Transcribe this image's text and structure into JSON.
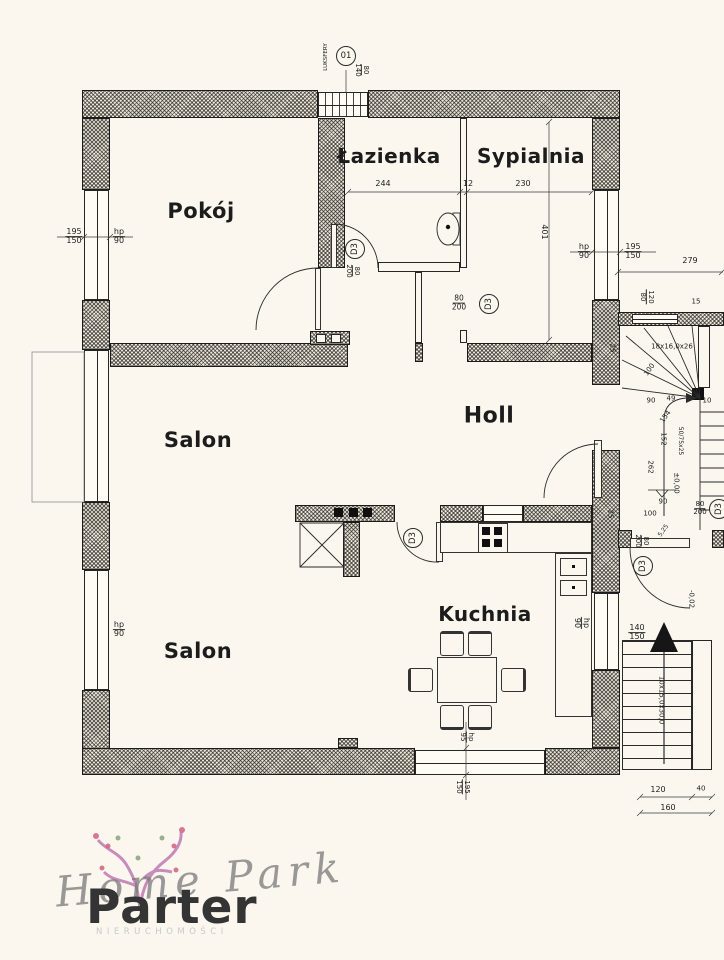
{
  "page_title": "Parter",
  "colors": {
    "background": "#fbf7ee",
    "line": "#262626",
    "wall_fill": "#ece5d6",
    "logo_pink": "#c07ab2",
    "logo_green": "#8aab7e",
    "logo_gray": "#9b9b9b",
    "logo_title_color": "#343434"
  },
  "logo": {
    "script": "Home Park",
    "subtitle": "NIERUCHOMOŚCI",
    "floor_title": "Parter"
  },
  "rooms": [
    {
      "t": "Pokój",
      "x": 201,
      "y": 211,
      "fs": 21
    },
    {
      "t": "Łazienka",
      "x": 389,
      "y": 156,
      "fs": 20
    },
    {
      "t": "Sypialnia",
      "x": 531,
      "y": 156,
      "fs": 20
    },
    {
      "t": "Salon",
      "x": 198,
      "y": 440,
      "fs": 21
    },
    {
      "t": "Holl",
      "x": 489,
      "y": 416,
      "fs": 22
    },
    {
      "t": "Salon",
      "x": 198,
      "y": 651,
      "fs": 21
    },
    {
      "t": "Kuchnia",
      "x": 485,
      "y": 614,
      "fs": 20
    }
  ],
  "door_tags": [
    {
      "t": "01",
      "x": 346,
      "y": 56,
      "n": "glass-block-window-tag"
    },
    {
      "t": "D3",
      "x": 355,
      "y": 249,
      "r": -90,
      "n": "door-tag-bathroom"
    },
    {
      "t": "D3",
      "x": 489,
      "y": 304,
      "r": -90,
      "n": "door-tag-bedroom"
    },
    {
      "t": "D3",
      "x": 413,
      "y": 538,
      "r": -90,
      "n": "door-tag-kitchen"
    },
    {
      "t": "D3",
      "x": 643,
      "y": 566,
      "r": -90,
      "n": "door-tag-back-entrance"
    },
    {
      "t": "D3",
      "x": 719,
      "y": 509,
      "r": -90,
      "n": "door-tag-stairwell"
    }
  ],
  "dimensions": [
    {
      "t": "LUKSFERY",
      "x": 327,
      "y": 57,
      "r": -90,
      "fs": 5.5
    },
    {
      "t": "80|140",
      "x": 361,
      "y": 70,
      "r": 90,
      "fs": 7
    },
    {
      "t": "244",
      "x": 383,
      "y": 184
    },
    {
      "t": "12",
      "x": 468,
      "y": 184
    },
    {
      "t": "230",
      "x": 523,
      "y": 184
    },
    {
      "t": "401",
      "x": 544,
      "y": 232,
      "r": 90
    },
    {
      "t": "195|150",
      "x": 74,
      "y": 237
    },
    {
      "t": "hp|90",
      "x": 119,
      "y": 237
    },
    {
      "t": "hp|90",
      "x": 584,
      "y": 252
    },
    {
      "t": "195|150",
      "x": 633,
      "y": 252
    },
    {
      "t": "279",
      "x": 690,
      "y": 261
    },
    {
      "t": "120|80",
      "x": 646,
      "y": 297,
      "r": 90,
      "fs": 7
    },
    {
      "t": "15",
      "x": 696,
      "y": 302,
      "fs": 7
    },
    {
      "t": "80|200",
      "x": 352,
      "y": 271,
      "r": 90,
      "fs": 7
    },
    {
      "t": "80|200",
      "x": 459,
      "y": 303,
      "fs": 7.5
    },
    {
      "t": "18x16,0x26",
      "x": 672,
      "y": 347,
      "fs": 7
    },
    {
      "t": "25",
      "x": 612,
      "y": 348,
      "r": 90,
      "fs": 7
    },
    {
      "t": "100",
      "x": 650,
      "y": 370,
      "r": -55,
      "fs": 7
    },
    {
      "t": "90",
      "x": 651,
      "y": 401,
      "fs": 7
    },
    {
      "t": "49",
      "x": 671,
      "y": 399,
      "fs": 7
    },
    {
      "t": "10",
      "x": 707,
      "y": 401,
      "fs": 7
    },
    {
      "t": "154",
      "x": 666,
      "y": 417,
      "r": -55,
      "fs": 7
    },
    {
      "t": "152",
      "x": 663,
      "y": 439,
      "r": 90,
      "fs": 7
    },
    {
      "t": "50/75x25",
      "x": 680,
      "y": 441,
      "r": 90,
      "fs": 6
    },
    {
      "t": "262",
      "x": 650,
      "y": 467,
      "r": 90,
      "fs": 7
    },
    {
      "t": "±0,00",
      "x": 676,
      "y": 483,
      "r": 90,
      "fs": 7
    },
    {
      "t": "90",
      "x": 663,
      "y": 502,
      "fs": 7
    },
    {
      "t": "100",
      "x": 650,
      "y": 514,
      "fs": 7
    },
    {
      "t": "25",
      "x": 610,
      "y": 514,
      "r": 90,
      "fs": 7
    },
    {
      "t": "5,25",
      "x": 664,
      "y": 531,
      "r": -55,
      "fs": 6
    },
    {
      "t": "80|200",
      "x": 700,
      "y": 509,
      "fs": 7
    },
    {
      "t": "80|200",
      "x": 641,
      "y": 541,
      "r": 90,
      "fs": 7
    },
    {
      "t": "-0,02",
      "x": 691,
      "y": 599,
      "r": 90,
      "fs": 7
    },
    {
      "t": "hp|90",
      "x": 581,
      "y": 623,
      "r": 90
    },
    {
      "t": "140|150",
      "x": 637,
      "y": 633
    },
    {
      "t": "10x15,0x30,0",
      "x": 661,
      "y": 700,
      "r": 90,
      "fs": 7
    },
    {
      "t": "hp|90",
      "x": 119,
      "y": 630
    },
    {
      "t": "hp|95",
      "x": 466,
      "y": 737,
      "r": 90,
      "fs": 7
    },
    {
      "t": "195|150",
      "x": 462,
      "y": 787,
      "r": 90,
      "fs": 7
    },
    {
      "t": "120",
      "x": 658,
      "y": 790
    },
    {
      "t": "40",
      "x": 701,
      "y": 789,
      "fs": 7
    },
    {
      "t": "160",
      "x": 668,
      "y": 808
    }
  ]
}
